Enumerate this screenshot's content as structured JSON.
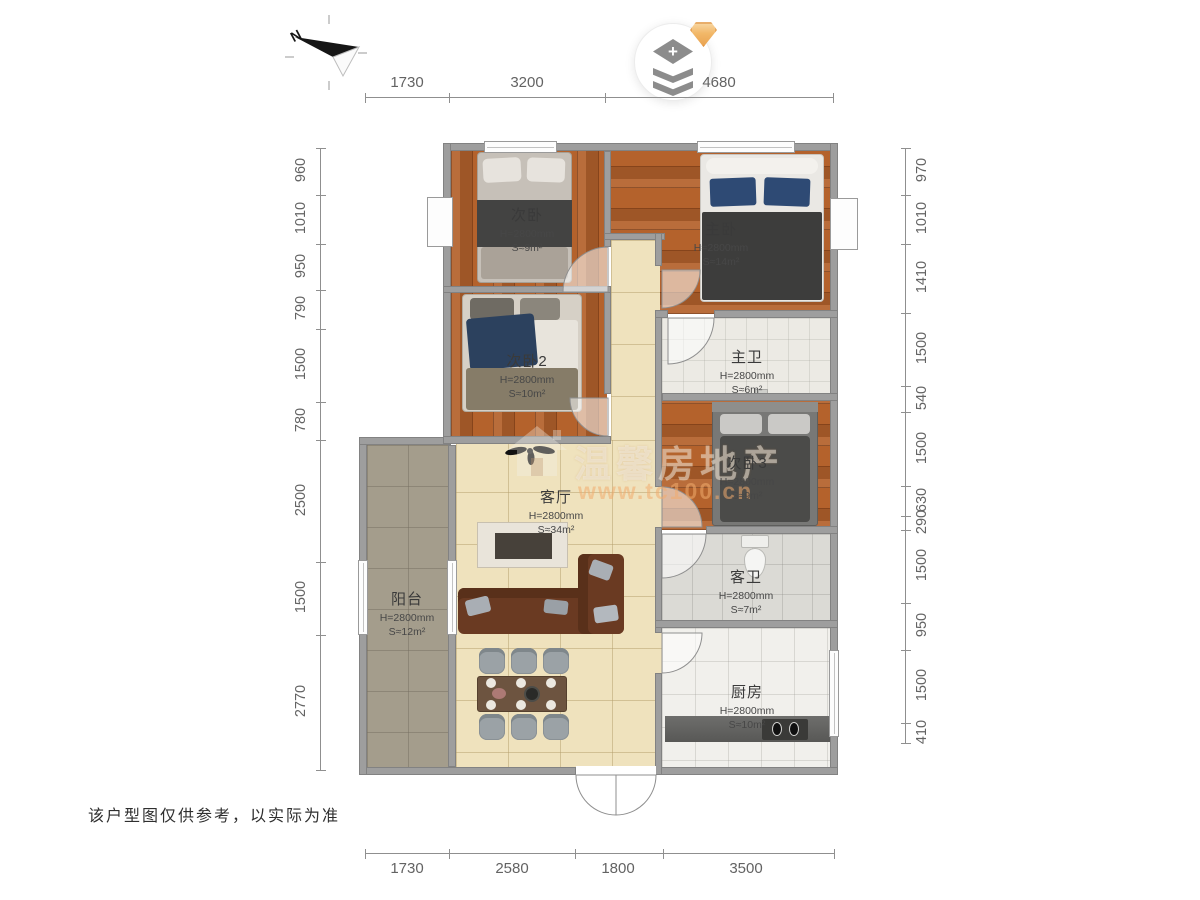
{
  "page": {
    "disclaimer": "该户型图仅供参考，以实际为准"
  },
  "compass": {
    "north_label": "N"
  },
  "header_button": {
    "plus_glyph": "+"
  },
  "watermark": {
    "brand": "温馨房地产",
    "url": "www.tc100.cn"
  },
  "rooms": {
    "cibed1": {
      "name": "次卧",
      "height": "H=2800mm",
      "area": "S≈9m²"
    },
    "master": {
      "name": "主卧",
      "height": "H=2800mm",
      "area": "S≈14m²"
    },
    "cibed2": {
      "name": "次卧2",
      "height": "H=2800mm",
      "area": "S≈10m²"
    },
    "masterbath": {
      "name": "主卫",
      "height": "H=2800mm",
      "area": "S≈6m²"
    },
    "cibed3": {
      "name": "次卧3",
      "height": "H=2800mm",
      "area": "S≈9m²"
    },
    "living": {
      "name": "客厅",
      "height": "H=2800mm",
      "area": "S≈34m²"
    },
    "guestbath": {
      "name": "客卫",
      "height": "H=2800mm",
      "area": "S≈7m²"
    },
    "balcony": {
      "name": "阳台",
      "height": "H=2800mm",
      "area": "S≈12m²"
    },
    "kitchen": {
      "name": "厨房",
      "height": "H=2800mm",
      "area": "S≈10m²"
    }
  },
  "dimensions": {
    "top": [
      "1730",
      "3200",
      "4680"
    ],
    "bottom": [
      "1730",
      "2580",
      "1800",
      "3500"
    ],
    "left": [
      "960",
      "1010",
      "950",
      "790",
      "1500",
      "780",
      "2500",
      "1500",
      "2770"
    ],
    "right": [
      "970",
      "1010",
      "1410",
      "1500",
      "540",
      "1500",
      "630",
      "290",
      "1500",
      "950",
      "1500",
      "410"
    ]
  },
  "colors": {
    "wood": "#b4622c",
    "tile": "#efe2bd",
    "wall": "#9e9e9e",
    "accent_gem": "#f2b869",
    "dim_text": "#636363"
  }
}
